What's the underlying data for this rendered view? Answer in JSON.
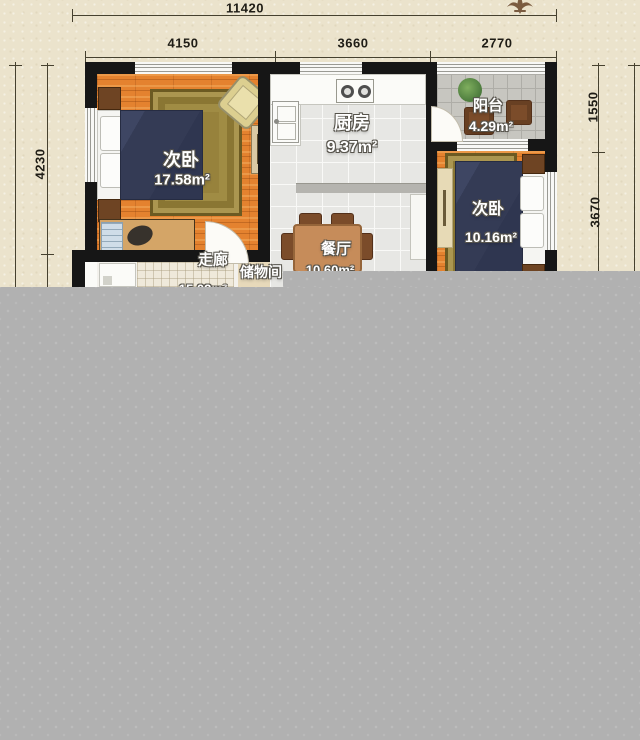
{
  "plan": {
    "rooms": [
      {
        "label": "次卧",
        "area": "17.58m²"
      },
      {
        "label": "厨房",
        "area": "9.37m²"
      },
      {
        "label": "阳台",
        "area": "4.29m²"
      },
      {
        "label": "次卧",
        "area": "10.16m²"
      },
      {
        "label": "餐厅",
        "area": "10.60m²"
      },
      {
        "label": "走廊",
        "area": "15.02m²"
      },
      {
        "label": "储物间",
        "area": ""
      }
    ],
    "dimensions": {
      "top_total": "11420",
      "top_segments": [
        "4150",
        "3660",
        "2770"
      ],
      "left_height": "4230",
      "right_segments": [
        "1550",
        "3670"
      ]
    },
    "colors": {
      "background": "#ebe3cc",
      "wall": "#161616",
      "wood_floor": "#e4822f",
      "tile_floor": "#e7e7e4",
      "overlay": "#b1b1b1",
      "label_text": "#ffffff"
    }
  }
}
